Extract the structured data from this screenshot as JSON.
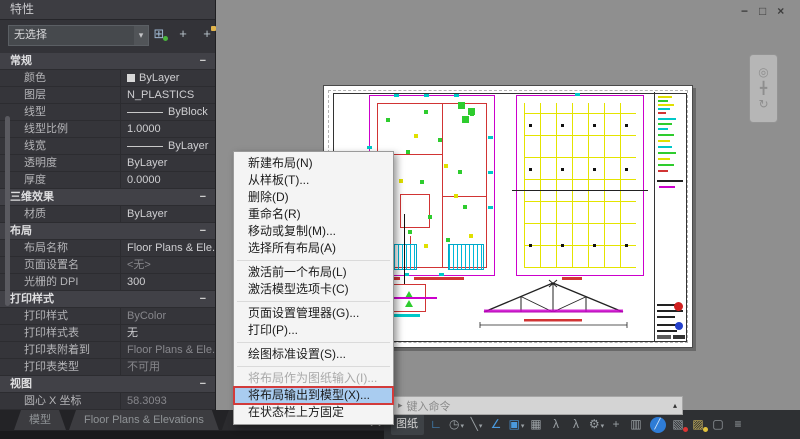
{
  "window": {
    "controls": [
      {
        "name": "minimize-icon",
        "glyph": "−"
      },
      {
        "name": "restore-icon",
        "glyph": "□"
      },
      {
        "name": "close-icon",
        "glyph": "×"
      }
    ]
  },
  "palette": {
    "title": "特性",
    "selector": {
      "value": "无选择",
      "caret": "▾"
    },
    "toolbar": [
      {
        "name": "toggle-pickadd-icon",
        "glyph": "⊞",
        "cls": "first-sq"
      },
      {
        "name": "select-objects-icon",
        "glyph": "+"
      },
      {
        "name": "quick-select-icon",
        "glyph": "+",
        "cls": "spark"
      }
    ],
    "rows": [
      {
        "cls": "sec",
        "label": "常规",
        "glyph": "−"
      },
      {
        "cls": "has-swatch",
        "label": "颜色",
        "value": "ByLayer"
      },
      {
        "cls": "",
        "label": "图层",
        "value": "N_PLASTICS"
      },
      {
        "cls": "has-line",
        "label": "线型",
        "value": "ByBlock"
      },
      {
        "cls": "",
        "label": "线型比例",
        "value": "1.0000"
      },
      {
        "cls": "has-line",
        "label": "线宽",
        "value": "ByLayer"
      },
      {
        "cls": "",
        "label": "透明度",
        "value": "ByLayer"
      },
      {
        "cls": "",
        "label": "厚度",
        "value": "0.0000"
      },
      {
        "cls": "sec",
        "label": "三维效果",
        "glyph": "−"
      },
      {
        "cls": "",
        "label": "材质",
        "value": "ByLayer"
      },
      {
        "cls": "sec",
        "label": "布局",
        "glyph": "−"
      },
      {
        "cls": "",
        "label": "布局名称",
        "value": "Floor Plans & Ele..."
      },
      {
        "cls": "muted",
        "label": "页面设置名",
        "value": "<无>"
      },
      {
        "cls": "",
        "label": "光栅的 DPI",
        "value": "300"
      },
      {
        "cls": "sec",
        "label": "打印样式",
        "glyph": "−"
      },
      {
        "cls": "muted",
        "label": "打印样式",
        "value": "ByColor"
      },
      {
        "cls": "",
        "label": "打印样式表",
        "value": "无"
      },
      {
        "cls": "muted",
        "label": "打印表附着到",
        "value": "Floor Plans & Ele..."
      },
      {
        "cls": "muted",
        "label": "打印表类型",
        "value": "不可用"
      },
      {
        "cls": "sec",
        "label": "视图",
        "glyph": "−"
      },
      {
        "cls": "muted",
        "label": "圆心 X 坐标",
        "value": "58.3093"
      }
    ]
  },
  "context_menu": {
    "items": [
      {
        "cls": "",
        "label": "新建布局(N)"
      },
      {
        "cls": "",
        "label": "从样板(T)..."
      },
      {
        "cls": "",
        "label": "删除(D)"
      },
      {
        "cls": "",
        "label": "重命名(R)"
      },
      {
        "cls": "",
        "label": "移动或复制(M)..."
      },
      {
        "cls": "",
        "label": "选择所有布局(A)"
      },
      {
        "cls": "sep"
      },
      {
        "cls": "",
        "label": "激活前一个布局(L)"
      },
      {
        "cls": "",
        "label": "激活模型选项卡(C)"
      },
      {
        "cls": "sep"
      },
      {
        "cls": "",
        "label": "页面设置管理器(G)..."
      },
      {
        "cls": "",
        "label": "打印(P)..."
      },
      {
        "cls": "sep"
      },
      {
        "cls": "",
        "label": "绘图标准设置(S)..."
      },
      {
        "cls": "sep"
      },
      {
        "cls": "disabled",
        "label": "将布局作为图纸输入(I)..."
      },
      {
        "cls": "hl",
        "label": "将布局输出到模型(X)..."
      },
      {
        "cls": "",
        "label": "在状态栏上方固定"
      }
    ]
  },
  "canvas": {
    "navigation_icons": [
      {
        "name": "zoom-icon",
        "glyph": "◎"
      },
      {
        "name": "pan-icon",
        "glyph": "╋"
      },
      {
        "name": "orbit-icon",
        "glyph": "↻"
      }
    ]
  },
  "command_line": {
    "prompt_icon": "▸",
    "placeholder": "键入命令",
    "history_caret": "▴"
  },
  "status_bar": {
    "overflow_glyph": "»",
    "items": [
      {
        "name": "paper-space-toggle",
        "glyph": "图纸",
        "cls": "textbtn"
      },
      {
        "name": "snap-mode-icon",
        "glyph": "∟",
        "cls": "on"
      },
      {
        "name": "grid-display-icon",
        "glyph": "◷",
        "caret": "▾"
      },
      {
        "name": "polar-tracking-icon",
        "glyph": "╲",
        "caret": "▾"
      },
      {
        "name": "isodraft-icon",
        "glyph": "∠",
        "cls": "on"
      },
      {
        "name": "object-snap-icon",
        "glyph": "▣",
        "cls": "on",
        "caret": "▾"
      },
      {
        "name": "selection-cycling-icon",
        "glyph": "▦"
      },
      {
        "name": "annotation-visibility-icon",
        "glyph": "λ"
      },
      {
        "name": "annotation-autoscale-icon",
        "glyph": "λ"
      },
      {
        "name": "workspace-switching-icon",
        "glyph": "⚙",
        "caret": "▾"
      },
      {
        "name": "annotation-monitor-icon",
        "glyph": "+"
      },
      {
        "name": "quick-properties-icon",
        "glyph": "▥"
      },
      {
        "name": "clean-screen-icon",
        "glyph": "╱",
        "cls": "bluecircle"
      },
      {
        "name": "isolate-objects-icon",
        "glyph": "▧",
        "cls": "warn-red"
      },
      {
        "name": "trusted-sources-icon",
        "glyph": "▨",
        "cls": "warn-yellow"
      },
      {
        "name": "fullscreen-icon",
        "glyph": "▢"
      },
      {
        "name": "customization-icon",
        "glyph": "≡"
      }
    ]
  },
  "layout_tabs": {
    "tabs": [
      {
        "cls": "",
        "label": "模型"
      },
      {
        "cls": "",
        "label": "Floor Plans & Elevations"
      },
      {
        "cls": "active",
        "label": "Floor Plans & Elevations (2)"
      }
    ]
  },
  "colors": {
    "accent_blue": "#4a9ade",
    "highlight_red": "#d23b3b",
    "menu_highlight": "#a9ccf0",
    "canvas_gray": "#8f8f8f",
    "drawing_magenta": "#cc00cc",
    "drawing_red": "#d13434",
    "drawing_green": "#2ecc2e",
    "drawing_yellow": "#e0e000",
    "drawing_cyan": "#00c8c8"
  }
}
